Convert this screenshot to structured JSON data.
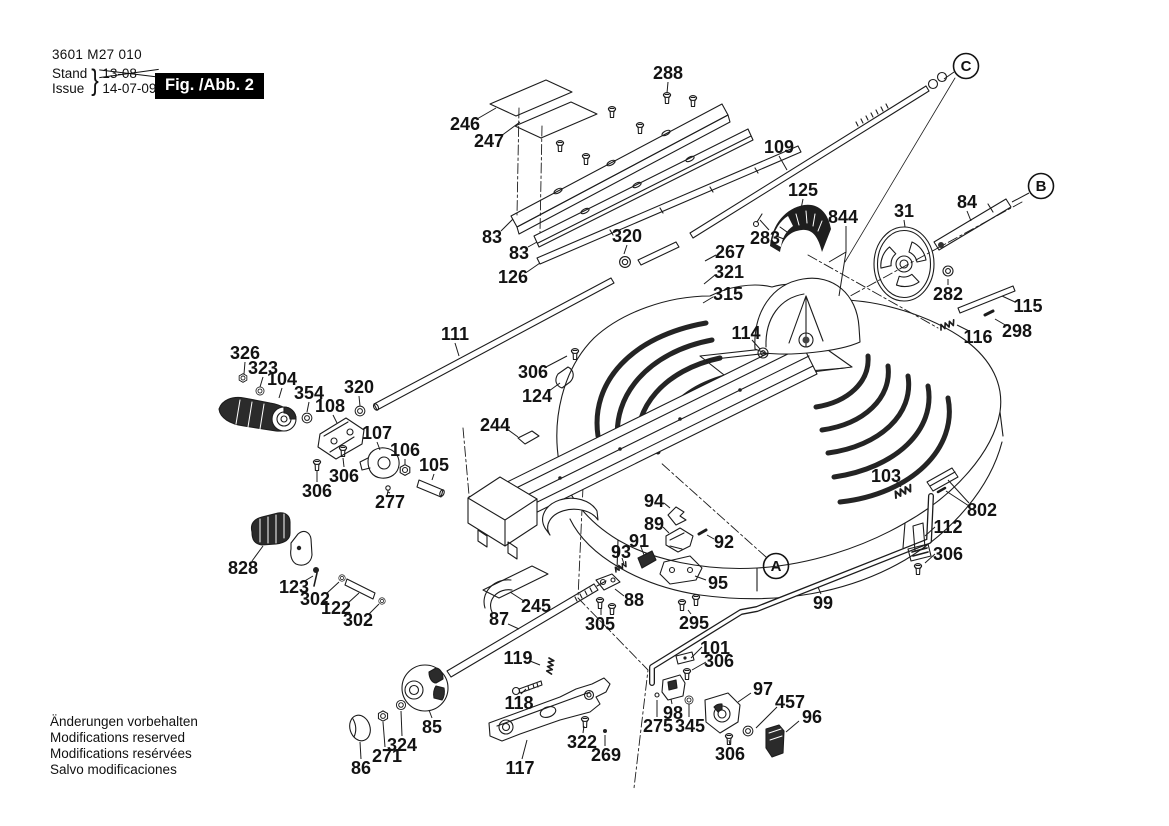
{
  "doc": {
    "part_number": "3601 M27 010",
    "stand_label": "Stand",
    "issue_label": "Issue",
    "brace": "}",
    "superseded_date": "13-08",
    "issue_date": "14-07-09",
    "figure_label": "Fig. /Abb. 2",
    "footer_lines": [
      "Änderungen vorbehalten",
      "Modifications reserved",
      "Modifications resérvées",
      "Salvo modificaciones"
    ]
  },
  "colors": {
    "ink": "#1c1c1c",
    "paper": "#ffffff",
    "shade": "#2b2b2b"
  },
  "view_labels": [
    {
      "letter": "A",
      "x": 776,
      "y": 566,
      "leader": null
    },
    {
      "letter": "B",
      "x": 1041,
      "y": 186,
      "leader": [
        1029,
        193,
        1012,
        202
      ]
    },
    {
      "letter": "C",
      "x": 966,
      "y": 66,
      "leader": [
        954,
        72,
        944,
        79
      ]
    }
  ],
  "part_labels": [
    {
      "text": "288",
      "x": 668,
      "y": 73,
      "leader": [
        668,
        82,
        667,
        93
      ]
    },
    {
      "text": "246",
      "x": 465,
      "y": 124,
      "leader": [
        477,
        119,
        496,
        108
      ]
    },
    {
      "text": "247",
      "x": 489,
      "y": 141,
      "leader": [
        501,
        136,
        520,
        122
      ]
    },
    {
      "text": "83",
      "x": 492,
      "y": 237,
      "leader": [
        501,
        231,
        513,
        219
      ]
    },
    {
      "text": "83",
      "x": 519,
      "y": 253,
      "leader": [
        528,
        247,
        537,
        242
      ]
    },
    {
      "text": "126",
      "x": 513,
      "y": 277,
      "leader": [
        527,
        272,
        540,
        263
      ]
    },
    {
      "text": "320",
      "x": 627,
      "y": 236,
      "leader": [
        627,
        245,
        624,
        254
      ]
    },
    {
      "text": "109",
      "x": 779,
      "y": 147,
      "leader": [
        779,
        156,
        787,
        170
      ]
    },
    {
      "text": "125",
      "x": 803,
      "y": 190,
      "leader": [
        803,
        199,
        801,
        209
      ]
    },
    {
      "text": "844",
      "x": 843,
      "y": 217,
      "leader": [
        [
          846,
          226,
          846,
          252,
          829,
          262
        ],
        [
          846,
          252,
          839,
          296
        ]
      ]
    },
    {
      "text": "283",
      "x": 765,
      "y": 238,
      "leader": [
        769,
        230,
        760,
        220
      ]
    },
    {
      "text": "267",
      "x": 730,
      "y": 252,
      "leader": [
        716,
        255,
        705,
        261
      ]
    },
    {
      "text": "321",
      "x": 729,
      "y": 272,
      "leader": [
        715,
        275,
        704,
        284
      ]
    },
    {
      "text": "315",
      "x": 728,
      "y": 294,
      "leader": [
        713,
        297,
        703,
        303
      ]
    },
    {
      "text": "31",
      "x": 904,
      "y": 211,
      "leader": [
        904,
        220,
        905,
        227
      ]
    },
    {
      "text": "84",
      "x": 967,
      "y": 202,
      "leader": [
        967,
        211,
        971,
        221
      ]
    },
    {
      "text": "282",
      "x": 948,
      "y": 294,
      "leader": [
        948,
        285,
        948,
        279
      ]
    },
    {
      "text": "115",
      "x": 1028,
      "y": 306,
      "leader": [
        1015,
        302,
        1002,
        296
      ]
    },
    {
      "text": "116",
      "x": 978,
      "y": 337,
      "leader": [
        969,
        331,
        957,
        325
      ]
    },
    {
      "text": "298",
      "x": 1017,
      "y": 331,
      "leader": [
        1007,
        326,
        995,
        319
      ]
    },
    {
      "text": "114",
      "x": 746,
      "y": 333,
      "leader": [
        752,
        340,
        760,
        349
      ]
    },
    {
      "text": "111",
      "x": 455,
      "y": 334,
      "leader": [
        455,
        343,
        459,
        356
      ]
    },
    {
      "text": "306",
      "x": 533,
      "y": 372,
      "leader": [
        546,
        367,
        567,
        356
      ]
    },
    {
      "text": "124",
      "x": 537,
      "y": 396,
      "leader": [
        549,
        391,
        560,
        383
      ]
    },
    {
      "text": "244",
      "x": 495,
      "y": 425,
      "leader": [
        507,
        429,
        518,
        437
      ]
    },
    {
      "text": "326",
      "x": 245,
      "y": 353,
      "leader": [
        245,
        362,
        244,
        374
      ]
    },
    {
      "text": "323",
      "x": 263,
      "y": 368,
      "leader": [
        263,
        377,
        260,
        387
      ]
    },
    {
      "text": "104",
      "x": 282,
      "y": 379,
      "leader": [
        282,
        388,
        279,
        398
      ]
    },
    {
      "text": "354",
      "x": 309,
      "y": 393,
      "leader": [
        309,
        402,
        307,
        412
      ]
    },
    {
      "text": "108",
      "x": 330,
      "y": 406,
      "leader": [
        333,
        415,
        337,
        423
      ]
    },
    {
      "text": "320",
      "x": 359,
      "y": 387,
      "leader": [
        359,
        396,
        360,
        406
      ]
    },
    {
      "text": "107",
      "x": 377,
      "y": 433,
      "leader": [
        377,
        442,
        380,
        450
      ]
    },
    {
      "text": "106",
      "x": 405,
      "y": 450,
      "leader": [
        405,
        459,
        405,
        464
      ]
    },
    {
      "text": "105",
      "x": 434,
      "y": 465,
      "leader": [
        434,
        474,
        432,
        480
      ]
    },
    {
      "text": "306",
      "x": 344,
      "y": 476,
      "leader": [
        344,
        467,
        343,
        458
      ]
    },
    {
      "text": "306",
      "x": 317,
      "y": 491,
      "leader": [
        317,
        482,
        317,
        471
      ]
    },
    {
      "text": "277",
      "x": 390,
      "y": 502,
      "leader": [
        390,
        493,
        388,
        492
      ]
    },
    {
      "text": "828",
      "x": 243,
      "y": 568,
      "leader": [
        252,
        561,
        263,
        546
      ]
    },
    {
      "text": "123",
      "x": 294,
      "y": 587,
      "leader": [
        303,
        582,
        313,
        576
      ]
    },
    {
      "text": "302",
      "x": 315,
      "y": 599,
      "leader": [
        326,
        594,
        339,
        582
      ]
    },
    {
      "text": "122",
      "x": 336,
      "y": 608,
      "leader": [
        348,
        603,
        359,
        593
      ]
    },
    {
      "text": "302",
      "x": 358,
      "y": 620,
      "leader": [
        369,
        614,
        379,
        604
      ]
    },
    {
      "text": "87",
      "x": 499,
      "y": 619,
      "leader": [
        508,
        624,
        519,
        629
      ]
    },
    {
      "text": "245",
      "x": 536,
      "y": 606,
      "leader": [
        524,
        601,
        510,
        592
      ]
    },
    {
      "text": "119",
      "x": 518,
      "y": 658,
      "leader": [
        530,
        661,
        540,
        665
      ]
    },
    {
      "text": "118",
      "x": 519,
      "y": 703,
      "leader": [
        521,
        694,
        526,
        689
      ]
    },
    {
      "text": "85",
      "x": 432,
      "y": 727,
      "leader": [
        432,
        718,
        429,
        710
      ]
    },
    {
      "text": "324",
      "x": 402,
      "y": 745,
      "leader": [
        402,
        736,
        401,
        711
      ]
    },
    {
      "text": "271",
      "x": 387,
      "y": 756,
      "leader": [
        385,
        747,
        383,
        722
      ]
    },
    {
      "text": "86",
      "x": 361,
      "y": 768,
      "leader": [
        361,
        759,
        360,
        742
      ]
    },
    {
      "text": "117",
      "x": 520,
      "y": 768,
      "leader": [
        522,
        759,
        527,
        740
      ]
    },
    {
      "text": "322",
      "x": 582,
      "y": 742,
      "leader": [
        583,
        733,
        584,
        726
      ]
    },
    {
      "text": "269",
      "x": 606,
      "y": 755,
      "leader": [
        605,
        746,
        605,
        735
      ]
    },
    {
      "text": "94",
      "x": 654,
      "y": 501,
      "leader": [
        664,
        503,
        670,
        508
      ]
    },
    {
      "text": "89",
      "x": 654,
      "y": 524,
      "leader": [
        663,
        527,
        669,
        533
      ]
    },
    {
      "text": "91",
      "x": 639,
      "y": 541,
      "leader": [
        641,
        547,
        644,
        555
      ]
    },
    {
      "text": "93",
      "x": 621,
      "y": 552,
      "leader": [
        622,
        558,
        624,
        564
      ]
    },
    {
      "text": "92",
      "x": 724,
      "y": 542,
      "leader": [
        714,
        539,
        707,
        535
      ]
    },
    {
      "text": "95",
      "x": 718,
      "y": 583,
      "leader": [
        706,
        580,
        695,
        576
      ]
    },
    {
      "text": "88",
      "x": 634,
      "y": 600,
      "leader": [
        624,
        596,
        615,
        589
      ]
    },
    {
      "text": "305",
      "x": 600,
      "y": 624,
      "leader": [
        601,
        615,
        601,
        609
      ]
    },
    {
      "text": "295",
      "x": 694,
      "y": 623,
      "leader": [
        691,
        614,
        688,
        610
      ]
    },
    {
      "text": "99",
      "x": 823,
      "y": 603,
      "leader": [
        821,
        594,
        818,
        587
      ]
    },
    {
      "text": "101",
      "x": 715,
      "y": 648,
      "leader": [
        702,
        647,
        691,
        658
      ]
    },
    {
      "text": "306",
      "x": 719,
      "y": 661,
      "leader": [
        706,
        662,
        692,
        670
      ]
    },
    {
      "text": "97",
      "x": 763,
      "y": 689,
      "leader": [
        751,
        693,
        738,
        702
      ]
    },
    {
      "text": "457",
      "x": 790,
      "y": 702,
      "leader": [
        777,
        707,
        756,
        728
      ]
    },
    {
      "text": "96",
      "x": 812,
      "y": 717,
      "leader": [
        799,
        721,
        786,
        732
      ]
    },
    {
      "text": "98",
      "x": 673,
      "y": 713,
      "leader": [
        672,
        704,
        671,
        699
      ]
    },
    {
      "text": "275",
      "x": 658,
      "y": 726,
      "leader": [
        657,
        717,
        657,
        700
      ]
    },
    {
      "text": "345",
      "x": 690,
      "y": 726,
      "leader": [
        689,
        717,
        689,
        704
      ]
    },
    {
      "text": "306",
      "x": 730,
      "y": 754,
      "leader": [
        730,
        745,
        729,
        740
      ]
    },
    {
      "text": "103",
      "x": 886,
      "y": 476,
      "leader": [
        896,
        481,
        901,
        487
      ]
    },
    {
      "text": "802",
      "x": 982,
      "y": 510,
      "leader": [
        [
          969,
          503,
          948,
          480
        ],
        [
          969,
          506,
          946,
          491
        ]
      ]
    },
    {
      "text": "112",
      "x": 948,
      "y": 527,
      "leader": [
        935,
        527,
        925,
        536
      ]
    },
    {
      "text": "306",
      "x": 948,
      "y": 554,
      "leader": [
        935,
        554,
        925,
        563
      ]
    }
  ]
}
